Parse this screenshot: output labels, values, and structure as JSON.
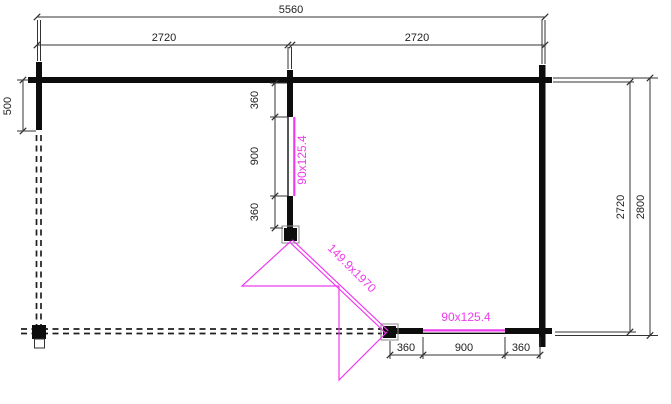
{
  "plan": {
    "background": "#ffffff",
    "ink_color": "#333333",
    "wall_color": "#0d0d0d",
    "accent_color": "#ee3cee",
    "dims": {
      "total_width": "5560",
      "span_left": "2720",
      "span_right": "2720",
      "side_return": "500",
      "mid_seg_top": "360",
      "mid_seg_window": "900",
      "mid_seg_bottom": "360",
      "right_inner_depth": "2720",
      "right_outer_depth": "2800",
      "bottom_seg_left": "360",
      "bottom_seg_window": "900",
      "bottom_seg_right": "360"
    },
    "labels": {
      "mid_window": "90x125.4",
      "bottom_window": "90x125.4",
      "door": "149.9x1970"
    }
  }
}
